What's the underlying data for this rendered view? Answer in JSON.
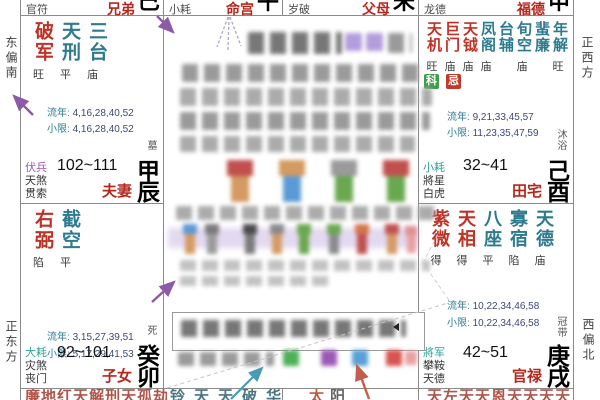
{
  "compass": {
    "left_top": "东偏南",
    "left_bottom": "正东方",
    "right_top": "正西方",
    "right_bottom": "西偏北"
  },
  "top_strip": [
    {
      "shensha": "官符",
      "palace": "兄弟",
      "branch": "巳"
    },
    {
      "shensha": "小耗",
      "palace": "命宫",
      "branch": "午"
    },
    {
      "shensha": "岁破",
      "palace": "父母",
      "branch": "未"
    },
    {
      "shensha": "龙德",
      "palace": "福德",
      "branch": "申"
    }
  ],
  "labels": {
    "liunian": "流年:",
    "xiaoxian": "小限:"
  },
  "palaces": {
    "chen": {
      "stars": [
        {
          "name": "破军"
        },
        {
          "name": "天刑"
        },
        {
          "name": "三台"
        }
      ],
      "statuses": [
        "旺",
        "平",
        "庙"
      ],
      "liunian": "4,16,28,40,52",
      "xiaoxian": "4,16,28,40,52",
      "shensha": [
        "伏兵",
        "天煞",
        "贯索"
      ],
      "ages": "102~111",
      "name": "夫妻",
      "gan": "甲",
      "zhi": "辰",
      "state": "墓"
    },
    "mao": {
      "stars": [
        {
          "name": "右弼"
        },
        {
          "name": "截空"
        }
      ],
      "statuses": [
        "陷",
        "平"
      ],
      "liunian": "3,15,27,39,51",
      "xiaoxian": "5,17,29,41,53",
      "shensha": [
        "大耗",
        "灾煞",
        "丧门"
      ],
      "ages": "92~101",
      "name": "子女",
      "gan": "癸",
      "zhi": "卯",
      "state": "死"
    },
    "you": {
      "stars": [
        {
          "name": "天机"
        },
        {
          "name": "巨门"
        },
        {
          "name": "天钺"
        },
        {
          "name": "凤阁"
        },
        {
          "name": "台辅"
        },
        {
          "name": "旬空"
        },
        {
          "name": "蜚廉"
        },
        {
          "name": "年解"
        }
      ],
      "statuses": [
        "旺",
        "庙",
        "庙",
        "庙",
        "",
        "庙",
        "",
        "旺"
      ],
      "badges": [
        {
          "text": "科"
        },
        {
          "text": "忌"
        }
      ],
      "liunian": "9,21,33,45,57",
      "xiaoxian": "11,23,35,47,59",
      "shensha": [
        "小耗",
        "將星",
        "白虎"
      ],
      "ages": "32~41",
      "name": "田宅",
      "gan": "己",
      "zhi": "酉",
      "state": "沐浴"
    },
    "xu": {
      "stars": [
        {
          "name": "紫微"
        },
        {
          "name": "天相"
        },
        {
          "name": "八座"
        },
        {
          "name": "寡宿"
        },
        {
          "name": "天德"
        }
      ],
      "statuses": [
        "得",
        "得",
        "平",
        "陷",
        "庙"
      ],
      "liunian": "10,22,34,46,58",
      "xiaoxian": "10,22,34,46,58",
      "shensha": [
        "將军",
        "攀鞍",
        "天德"
      ],
      "ages": "42~51",
      "name": "官禄",
      "gan": "庚",
      "zhi": "戌",
      "state": "冠带"
    }
  },
  "bottom_strip": {
    "cell1": {
      "chars": [
        "廉",
        "地",
        "红",
        "天",
        "解",
        "刑",
        "天",
        "孤",
        "劫"
      ]
    },
    "cell2": {
      "chars": [
        "铃",
        "天",
        "天",
        "破",
        "华"
      ]
    },
    "cell3": {
      "chars": [
        "太",
        "阳"
      ]
    },
    "cell4": {
      "chars": [
        "天",
        "左",
        "天",
        "天",
        "恩",
        "天",
        "天",
        "天",
        "天"
      ]
    }
  },
  "colors": {
    "major_star": "#bf3226",
    "minor_star": "#2e7a8f",
    "palace_name": "#b5271d",
    "badge_ke": "#3f9e4d",
    "badge_ji": "#c0392b",
    "arrow_purple": "#8e5aa8",
    "arrow_blue": "#4a9ab5",
    "arrow_red": "#c0604a"
  },
  "center_panel": {
    "redacted": true
  }
}
